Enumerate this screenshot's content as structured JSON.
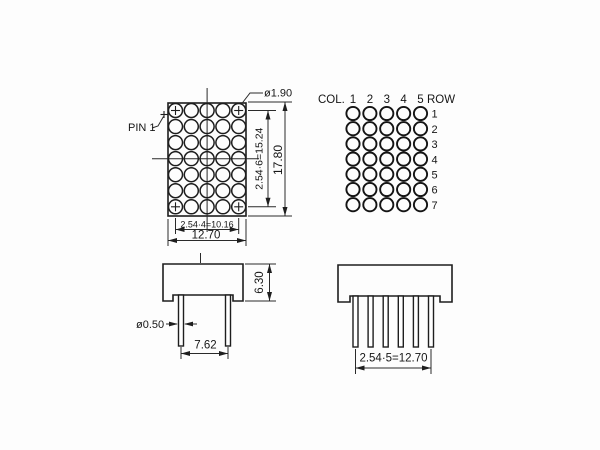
{
  "colors": {
    "ink": "#1e1e1e",
    "background": "#fdfdfd"
  },
  "front_view": {
    "pin1_label": "PIN 1",
    "dot_diameter": "ø1.90",
    "row_pitch_dim": "2.54·6=15.24",
    "height_dim": "17.80",
    "col_pitch_dim": "2.54·4=10.16",
    "width_dim": "12.70"
  },
  "pin_map": {
    "col_header": "COL.",
    "row_header": "ROW",
    "col_numbers": [
      "1",
      "2",
      "3",
      "4",
      "5"
    ],
    "row_numbers": [
      "1",
      "2",
      "3",
      "4",
      "5",
      "6",
      "7"
    ]
  },
  "side_view": {
    "body_height_dim": "6.30",
    "pin_diameter": "ø0.50",
    "pin_row_spacing_dim": "7.62"
  },
  "pin_row_view": {
    "pin_pitch_dim": "2.54·5=12.70"
  }
}
